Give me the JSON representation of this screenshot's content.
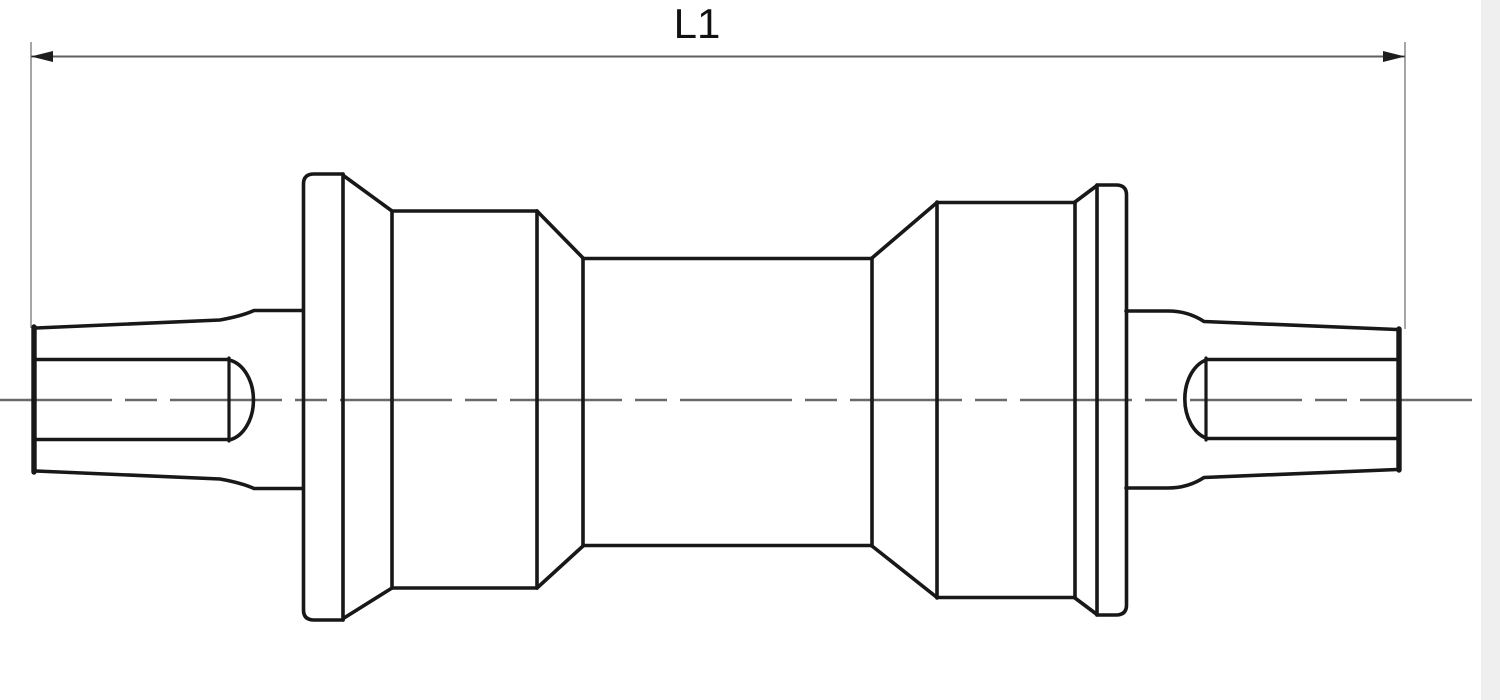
{
  "meta": {
    "description": "Technical outline drawing of a square-taper cartridge bottom bracket shown in side view with an overall length dimension"
  },
  "colors": {
    "background": "#ffffff",
    "right_gutter": "#efefef",
    "outline": "#181818",
    "construction": "#8f8f8f",
    "dimension_line": "#5f5f5f",
    "centerline": "#6a6a6a",
    "arrow": "#1d1d1d",
    "label": "#111111"
  },
  "dimension": {
    "label": "L1",
    "label_x": 697,
    "label_y": 38,
    "line": {
      "name": "dimension-line",
      "x1": 31,
      "x2": 1405,
      "y": 56.5,
      "width": 2
    },
    "extension_lines": [
      {
        "name": "extension-line-left",
        "x": 31,
        "y1": 42,
        "y2": 328,
        "width": 1.6
      },
      {
        "name": "extension-line-right",
        "x": 1405,
        "y1": 42,
        "y2": 329,
        "width": 1.6
      }
    ],
    "arrows": [
      {
        "name": "dimension-arrow-left",
        "points": "31,56.5 53,51 53,62"
      },
      {
        "name": "dimension-arrow-right",
        "points": "1405,56.5 1383,51 1383,62"
      }
    ]
  },
  "centerline": {
    "name": "centerline",
    "x1": 0,
    "x2": 1483,
    "y": 400,
    "dash": "112 13 32 13",
    "width": 2.4
  },
  "gutter": {
    "x": 1481,
    "y": 0,
    "width": 19,
    "height": 700
  },
  "part": {
    "default_stroke_width": 3.6,
    "strokes": [
      {
        "name": "left-spindle-tip-face",
        "d": "M 34 327 L 34 472",
        "w": 5.4
      },
      {
        "name": "left-spindle-top",
        "d": "M 36 328 L 220 320 Q 242 316 254 310.5 L 303 310.5"
      },
      {
        "name": "left-spindle-bottom",
        "d": "M 36 471 L 220 479 Q 242 483 254 488.5 L 303 488.5"
      },
      {
        "name": "left-taper-flat-top",
        "d": "M 37 359.5 L 229 359.5"
      },
      {
        "name": "left-taper-flat-bottom",
        "d": "M 37 439.5 L 229 439.5"
      },
      {
        "name": "left-taper-flat-chord",
        "d": "M 229 358 L 229 441",
        "w": 3.2
      },
      {
        "name": "left-taper-flat-arc",
        "d": "M 229 360 A 29 40.5 0 0 1 229 440"
      },
      {
        "name": "left-flange-outline",
        "d": "M 343 174 L 314 174 Q 303.5 174 303.5 184 L 303.5 610 Q 303.5 620 314 620 L 343 620"
      },
      {
        "name": "left-flange-right-edge",
        "d": "M 343 174 L 343 620"
      },
      {
        "name": "left-flange-to-cup-top",
        "d": "M 344 176 L 392 211"
      },
      {
        "name": "left-flange-to-cup-bottom",
        "d": "M 344 618 L 392 588"
      },
      {
        "name": "left-cup-left-edge",
        "d": "M 392 211 L 392 588"
      },
      {
        "name": "left-cup-top",
        "d": "M 392 211 L 537 211"
      },
      {
        "name": "left-cup-bottom",
        "d": "M 392 588 L 537 588"
      },
      {
        "name": "left-cup-right-edge",
        "d": "M 537 211 L 537 588"
      },
      {
        "name": "left-cone-top",
        "d": "M 537 211 L 583 258"
      },
      {
        "name": "left-cone-bottom",
        "d": "M 537 588 L 583 546"
      },
      {
        "name": "shell-tube-left-edge",
        "d": "M 583 258 L 583 546"
      },
      {
        "name": "shell-tube-top",
        "d": "M 583 258.5 L 872 258.5"
      },
      {
        "name": "shell-tube-bottom",
        "d": "M 583 545.5 L 872 545.5"
      },
      {
        "name": "shell-tube-right-edge",
        "d": "M 872 258 L 872 546"
      },
      {
        "name": "right-cone-top",
        "d": "M 872 258 L 937 202.5"
      },
      {
        "name": "right-cone-bottom",
        "d": "M 872 546 L 937 597.5"
      },
      {
        "name": "right-cup-left-edge",
        "d": "M 937 202 L 937 598"
      },
      {
        "name": "right-cup-top",
        "d": "M 937 202.5 L 1075 202.5"
      },
      {
        "name": "right-cup-bottom",
        "d": "M 937 597.5 L 1075 597.5"
      },
      {
        "name": "right-cup-right-edge",
        "d": "M 1075 202 L 1075 598"
      },
      {
        "name": "right-cup-to-flange-top",
        "d": "M 1075 202 L 1097 185.5"
      },
      {
        "name": "right-cup-to-flange-bottom",
        "d": "M 1075 598 L 1097 614.5"
      },
      {
        "name": "right-flange-left-edge",
        "d": "M 1097 185 L 1097 615"
      },
      {
        "name": "right-flange-outline",
        "d": "M 1097 185 L 1116 185 Q 1126.5 185 1126.5 195 L 1126.5 605 Q 1126.5 615 1116 615 L 1097 615"
      },
      {
        "name": "right-spindle-top",
        "d": "M 1126 311 L 1168 311 Q 1188 311 1204 321.5 L 1397 329.5"
      },
      {
        "name": "right-spindle-bottom",
        "d": "M 1126 488 L 1168 488 Q 1188 488 1204 477.5 L 1397 469.5"
      },
      {
        "name": "right-spindle-tip-face",
        "d": "M 1399 329 L 1399 470",
        "w": 5.4
      },
      {
        "name": "right-taper-flat-top",
        "d": "M 1206 359.5 L 1398 359.5"
      },
      {
        "name": "right-taper-flat-bottom",
        "d": "M 1206 438.5 L 1398 438.5"
      },
      {
        "name": "right-taper-flat-chord",
        "d": "M 1206 358 L 1206 440",
        "w": 3.2
      },
      {
        "name": "right-taper-flat-arc",
        "d": "M 1206 360 A 29 40.5 0 0 0 1206 438"
      }
    ]
  }
}
